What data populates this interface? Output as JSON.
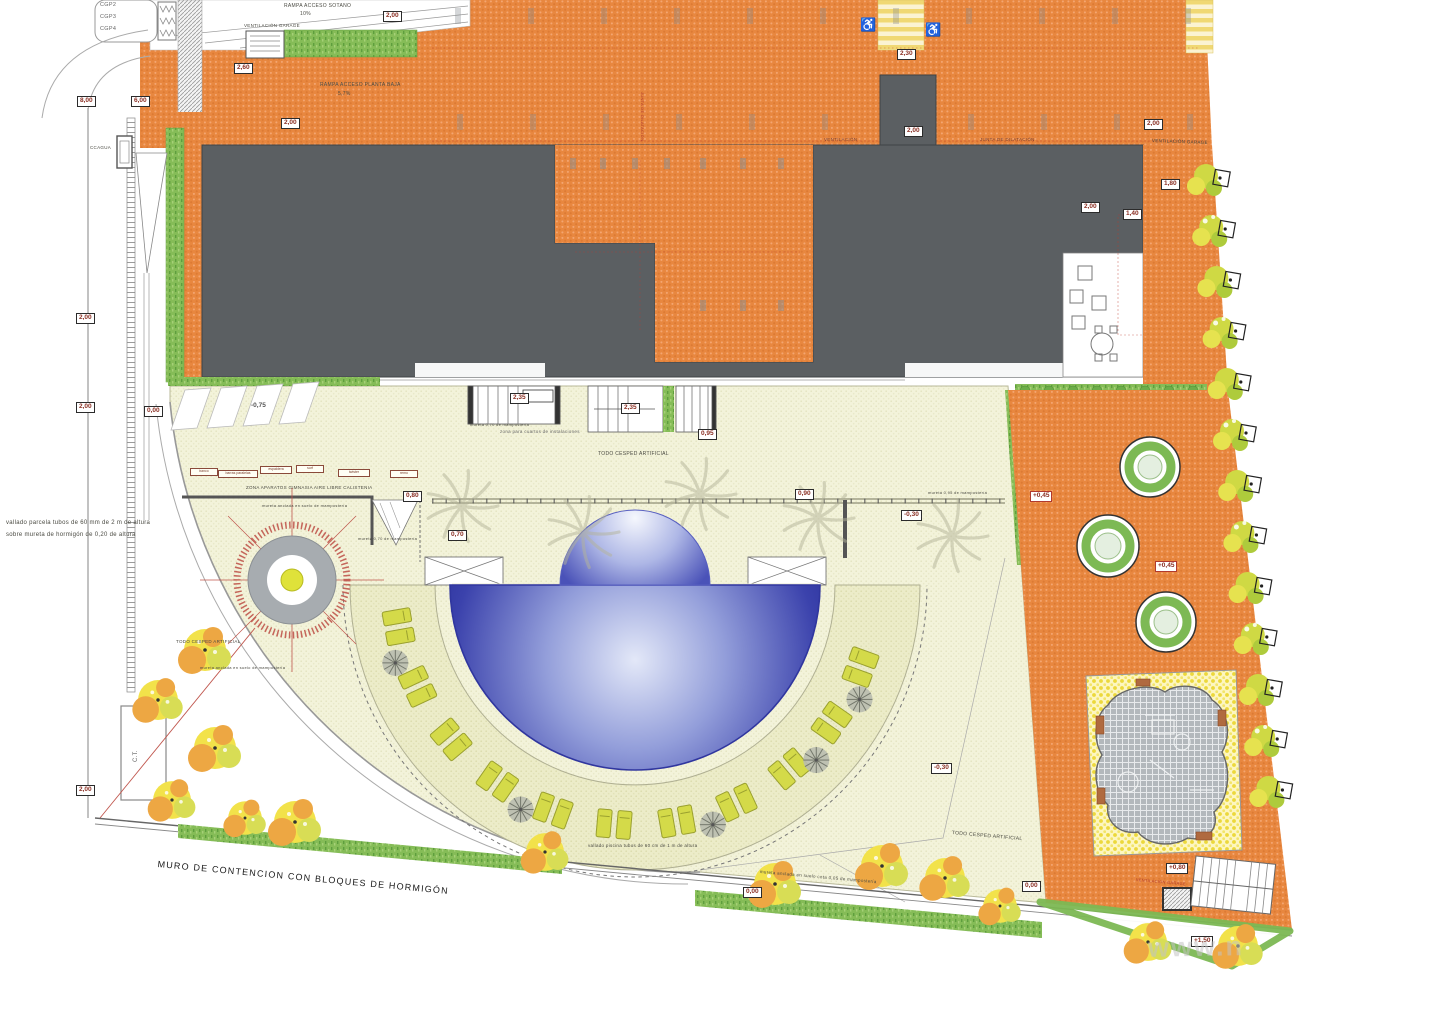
{
  "title": "Plano de urbanización - planta general",
  "icons": {
    "accessible": "♿"
  },
  "watermark": {
    "text": "www.n"
  },
  "colors": {
    "paving_orange": "#e8873f",
    "building_gray": "#5b5f62",
    "artificial_turf": "#f3f3da",
    "pool_deep_blue": "#272d9a",
    "pool_light_blue": "#dfe5f6",
    "hedge_green": "#85bc57",
    "tree_yellow": "#f2e24a",
    "tree_orange": "#eda743",
    "planter_green": "#7db954",
    "playground_surface": "#b3b8bc",
    "dimension_red": "#b03a2e"
  },
  "labels": [
    {
      "id": "ramp-sotano",
      "text": "RAMPA ACCESO SOTANO",
      "x": 284,
      "y": 4,
      "size": 5
    },
    {
      "id": "ramp-sotano-slope",
      "text": "10%",
      "x": 300,
      "y": 12,
      "size": 5
    },
    {
      "id": "vent-garage-topleft",
      "text": "VENTILACIÓN GARAGE",
      "x": 244,
      "y": 24,
      "size": 4.5
    },
    {
      "id": "ramp-planta-baja",
      "text": "RAMPA ACCESO PLANTA BAJA",
      "x": 320,
      "y": 83,
      "size": 5
    },
    {
      "id": "ramp-planta-baja-slope",
      "text": "5,7%",
      "x": 338,
      "y": 92,
      "size": 5
    },
    {
      "id": "cgp2",
      "text": "CGP2",
      "x": 100,
      "y": 3,
      "size": 5.5,
      "color": "#666"
    },
    {
      "id": "cgp3",
      "text": "CGP3",
      "x": 100,
      "y": 15,
      "size": 5.5,
      "color": "#666"
    },
    {
      "id": "cgp4",
      "text": "CGP4",
      "x": 100,
      "y": 27,
      "size": 5.5,
      "color": "#666"
    },
    {
      "id": "ccagua",
      "text": "CCAGUA",
      "x": 90,
      "y": 146,
      "size": 4.5
    },
    {
      "id": "ventilacion-bloque",
      "text": "VENTILACIÓN",
      "x": 824,
      "y": 138,
      "size": 4.5,
      "color": "#7a4030"
    },
    {
      "id": "junta-dilatacion",
      "text": "JUNTA DE DILATACIÓN",
      "x": 980,
      "y": 138,
      "size": 4.5,
      "color": "#7a4030"
    },
    {
      "id": "junta-dilatacion-vert",
      "text": "JUNTA DE DILATACIÓN",
      "x": 644,
      "y": 92,
      "size": 4,
      "rot": 90,
      "color": "#b03a2e"
    },
    {
      "id": "vent-garage-topright",
      "text": "VENTILACIÓN GARAGE",
      "x": 1152,
      "y": 139,
      "size": 4.5,
      "rot": 2
    },
    {
      "id": "zona-cuartos",
      "text": "zona para cuartos de instalaciones",
      "x": 500,
      "y": 430,
      "size": 4.5,
      "color": "#666"
    },
    {
      "id": "mureta-070-stair",
      "text": "mureta 0,70 de mampostería",
      "x": 470,
      "y": 423,
      "size": 4
    },
    {
      "id": "todo-cesped-centro",
      "text": "TODO CESPED ARTIFICIAL",
      "x": 598,
      "y": 452,
      "size": 5
    },
    {
      "id": "zona-gimnasia",
      "text": "ZONA APARATOS GIMNASIA AIRE LIBRE CALISTENIA",
      "x": 246,
      "y": 486,
      "size": 4.5
    },
    {
      "id": "mureta-gimnasia",
      "text": "mureta anclada en suelo de mampostería",
      "x": 262,
      "y": 504,
      "size": 4
    },
    {
      "id": "mureta-070",
      "text": "mureta 0,70 de mampostería",
      "x": 358,
      "y": 537,
      "size": 4
    },
    {
      "id": "mureta-095",
      "text": "mureta 0,95 de mampostería",
      "x": 928,
      "y": 491,
      "size": 4
    },
    {
      "id": "todo-cesped-izq",
      "text": "TODO CESPED ARTIFICIAL",
      "x": 176,
      "y": 640,
      "size": 4.5
    },
    {
      "id": "mureta-izq",
      "text": "mureta anclada en suelo de mampostería",
      "x": 200,
      "y": 666,
      "size": 4
    },
    {
      "id": "vallado-piscina",
      "text": "vallado piscina tubos de 60 cm de 1 m de altura",
      "x": 588,
      "y": 844,
      "size": 4.5
    },
    {
      "id": "mureta-005",
      "text": "mureta anclada en suelo cota 0,05 de mampostería",
      "x": 760,
      "y": 870,
      "size": 4.5,
      "rot": 5
    },
    {
      "id": "todo-cesped-der",
      "text": "TODO CESPED ARTIFICIAL",
      "x": 952,
      "y": 831,
      "size": 5,
      "rot": 5
    },
    {
      "id": "muro-contencion",
      "text": "MURO DE CONTENCION  CON BLOQUES DE HORMIGÓN",
      "x": 158,
      "y": 860,
      "size": 9,
      "rot": 5.3,
      "color": "#1a1a1a",
      "ls": 1.2
    },
    {
      "id": "nota-vallado-1",
      "text": "vallado parcela tubos de 60 mm de 2 m de altura",
      "x": 6,
      "y": 520,
      "size": 6
    },
    {
      "id": "nota-vallado-2",
      "text": "sobre mureta de hormigón de 0,20 de altura",
      "x": 6,
      "y": 532,
      "size": 6
    },
    {
      "id": "ct",
      "text": "C.T.",
      "x": 133,
      "y": 762,
      "size": 6,
      "rot": -90,
      "color": "#666"
    },
    {
      "id": "vent-garage-playground",
      "text": "VENTILACIÓN GARAGE",
      "x": 1136,
      "y": 878,
      "size": 4,
      "rot": 5,
      "color": "#b03a2e"
    }
  ],
  "badges": [
    {
      "text": "2,00",
      "x": 383,
      "y": 11
    },
    {
      "text": "2,60",
      "x": 234,
      "y": 63
    },
    {
      "text": "6,00",
      "x": 131,
      "y": 96
    },
    {
      "text": "8,00",
      "x": 77,
      "y": 96
    },
    {
      "text": "2,00",
      "x": 281,
      "y": 118
    },
    {
      "text": "2,30",
      "x": 897,
      "y": 49
    },
    {
      "text": "2,00",
      "x": 904,
      "y": 126
    },
    {
      "text": "2,00",
      "x": 1144,
      "y": 119
    },
    {
      "text": "2,00",
      "x": 1081,
      "y": 202
    },
    {
      "text": "1,40",
      "x": 1123,
      "y": 209
    },
    {
      "text": "1,80",
      "x": 1161,
      "y": 179
    },
    {
      "text": "2,00",
      "x": 76,
      "y": 402
    },
    {
      "text": "2,00",
      "x": 76,
      "y": 785
    },
    {
      "text": "2,00",
      "x": 76,
      "y": 313
    },
    {
      "text": "0,00",
      "x": 144,
      "y": 406
    },
    {
      "text": "2,35",
      "x": 510,
      "y": 393
    },
    {
      "text": "2,35",
      "x": 621,
      "y": 403
    },
    {
      "text": "0,95",
      "x": 698,
      "y": 429
    },
    {
      "text": "0,70",
      "x": 448,
      "y": 530
    },
    {
      "text": "0,80",
      "x": 403,
      "y": 491
    },
    {
      "text": "0,90",
      "x": 795,
      "y": 489
    },
    {
      "text": "+0,45",
      "x": 1030,
      "y": 491,
      "variant": "red"
    },
    {
      "text": "+0,45",
      "x": 1155,
      "y": 561,
      "variant": "red"
    },
    {
      "text": "-0,30",
      "x": 901,
      "y": 510
    },
    {
      "text": "-0,30",
      "x": 931,
      "y": 763
    },
    {
      "text": "0,00",
      "x": 743,
      "y": 887
    },
    {
      "text": "0,00",
      "x": 1022,
      "y": 881
    },
    {
      "text": "+0,80",
      "x": 1166,
      "y": 863
    },
    {
      "text": "+1,50",
      "x": 1191,
      "y": 936
    },
    {
      "text": "-0,75",
      "x": 249,
      "y": 402,
      "variant": "plain"
    }
  ],
  "equipment_boxes": [
    {
      "text": "banco",
      "x": 190,
      "y": 468,
      "w": 24
    },
    {
      "text": "barras paralelas",
      "x": 218,
      "y": 470,
      "w": 36
    },
    {
      "text": "espaldera",
      "x": 260,
      "y": 466,
      "w": 28
    },
    {
      "text": "surf",
      "x": 296,
      "y": 465,
      "w": 24
    },
    {
      "text": "twister",
      "x": 338,
      "y": 469,
      "w": 28
    },
    {
      "text": "remo",
      "x": 390,
      "y": 470,
      "w": 24
    }
  ]
}
